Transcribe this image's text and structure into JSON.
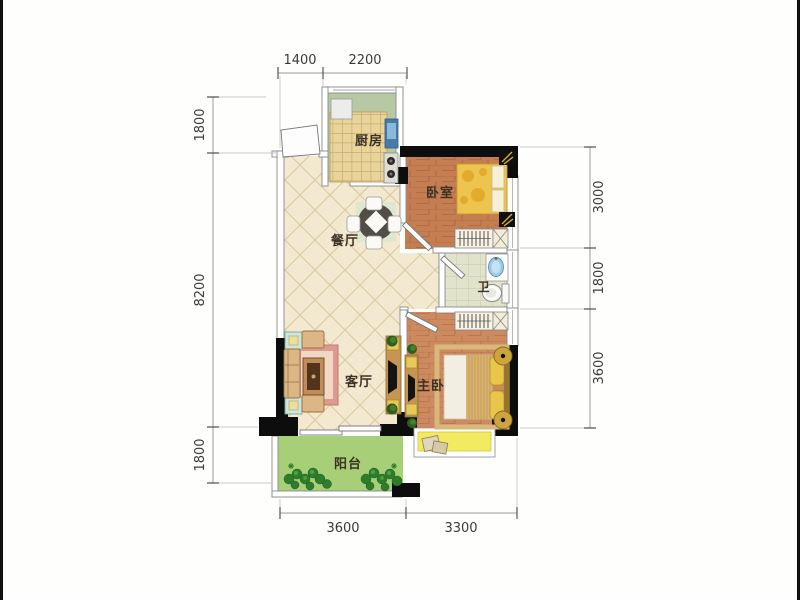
{
  "plan": {
    "title": "two-bedroom apartment floor plan",
    "rooms": {
      "kitchen": "厨房",
      "bedroom": "卧室",
      "dining": "餐厅",
      "bath": "卫",
      "living": "客厅",
      "master": "主卧",
      "balcony": "阳台"
    },
    "dimensions": {
      "top": [
        "1400",
        "2200"
      ],
      "left": [
        "1800",
        "8200",
        "1800"
      ],
      "right": [
        "3000",
        "1800",
        "3600"
      ],
      "bottom": [
        "3600",
        "3300"
      ]
    },
    "colors": {
      "structural_wall": "#0d0d0d",
      "tile_floor": "#f3e9d0",
      "bedroom_floor": "#c57e52",
      "master_floor": "#cc8a5e",
      "kitchen_floor": "#b7c9a4",
      "bath_floor": "#e1e3ca",
      "balcony_floor": "#a6cf78",
      "bay_window": "#f2ea60",
      "rug": "#dd9a92",
      "bedding": "#ecc44e"
    }
  }
}
